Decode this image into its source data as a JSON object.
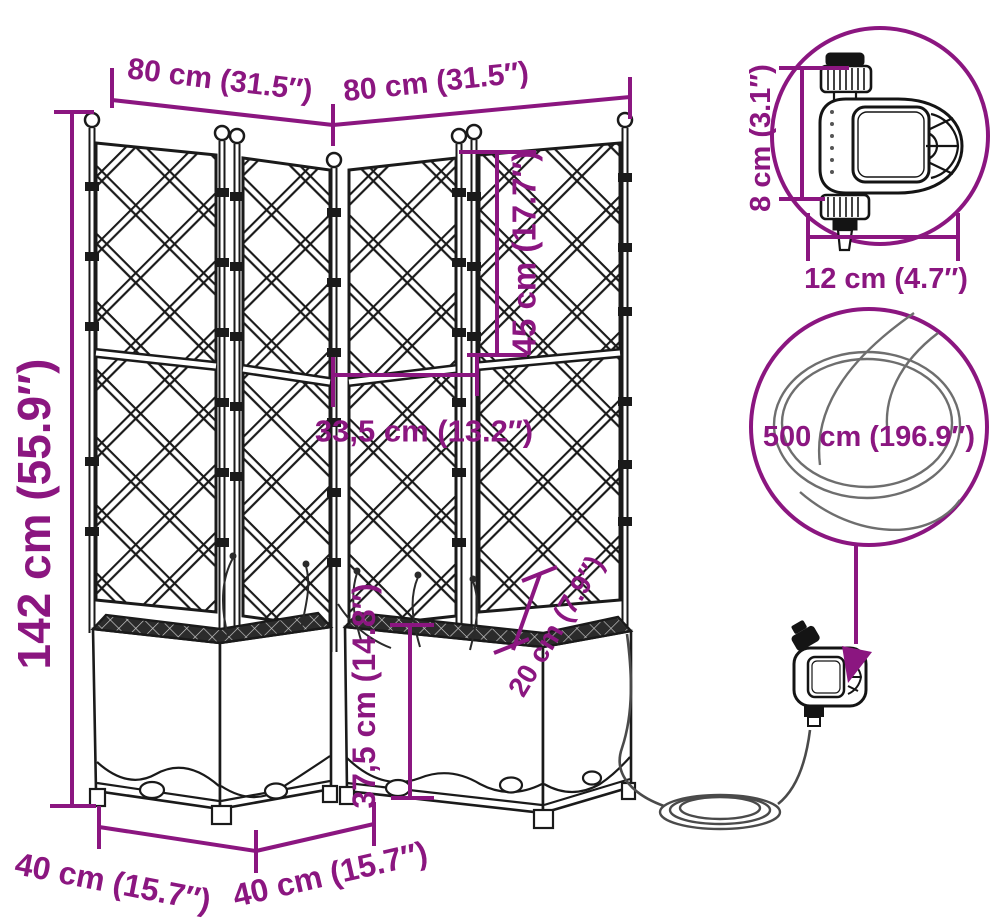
{
  "colors": {
    "accent": "#8B1680",
    "ink": "#1a1a1a",
    "hose": "#4a4a4a"
  },
  "labels": {
    "width_left": "80 cm (31.5″)",
    "width_right": "80 cm (31.5″)",
    "height_total": "142 cm (55.9″)",
    "panel_upper_height": "45 cm (17.7″)",
    "panel_width": "33,5 cm (13.2″)",
    "planter_height": "37,5 cm (14.8″)",
    "planting_depth": "20 cm (7.9″)",
    "base_left": "40 cm (15.7″)",
    "base_right": "40 cm (15.7″)",
    "timer_height": "8 cm (3.1″)",
    "timer_width": "12 cm (4.7″)",
    "hose_length": "500 cm (196.9″)"
  }
}
